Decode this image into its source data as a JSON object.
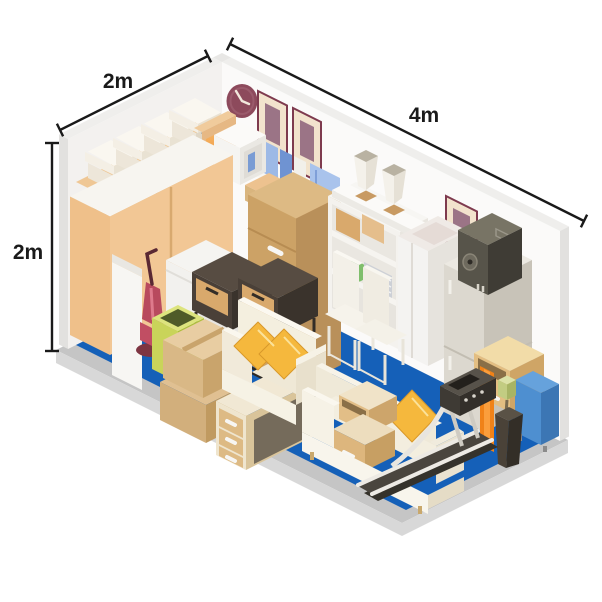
{
  "dimensions": {
    "width_label": "2m",
    "length_label": "4m",
    "height_label": "2m"
  },
  "colors": {
    "floor_blue": "#1560B8",
    "platform_grey": "#C5C5C5",
    "wall_light": "#F3F1EF",
    "wall_lighter": "#FBFAF9",
    "wood_light": "#F2C795",
    "wood_mid": "#D9B57E",
    "wood_dark": "#BA9058",
    "cushion_gold": "#F5B83D",
    "clock_plum": "#8D4A5C",
    "frame_maroon": "#7E3A4E",
    "espresso_dark": "#4A4038",
    "bin_green": "#C9D45A",
    "bowl_green": "#7FBE6C",
    "case_blue": "#4E8FD0",
    "accent_orange": "#F08218",
    "dimension_line": "#1A1A1A"
  },
  "scene": {
    "title": "isometric-storage-unit",
    "items": [
      "wardrobe",
      "louvre-cabinet",
      "storage-boxes",
      "wall-clock",
      "picture-frames",
      "chest-of-drawers",
      "book-shelf",
      "shelving-unit",
      "vases",
      "washing-machine",
      "refrigerator",
      "speaker",
      "white-chairs",
      "armchair",
      "gold-cushions",
      "sofa",
      "nightstands",
      "desk",
      "cardboard-boxes",
      "vacuum-cleaner",
      "green-bin",
      "treadmill",
      "plant-pot",
      "blue-case",
      "mini-cabinet"
    ]
  }
}
